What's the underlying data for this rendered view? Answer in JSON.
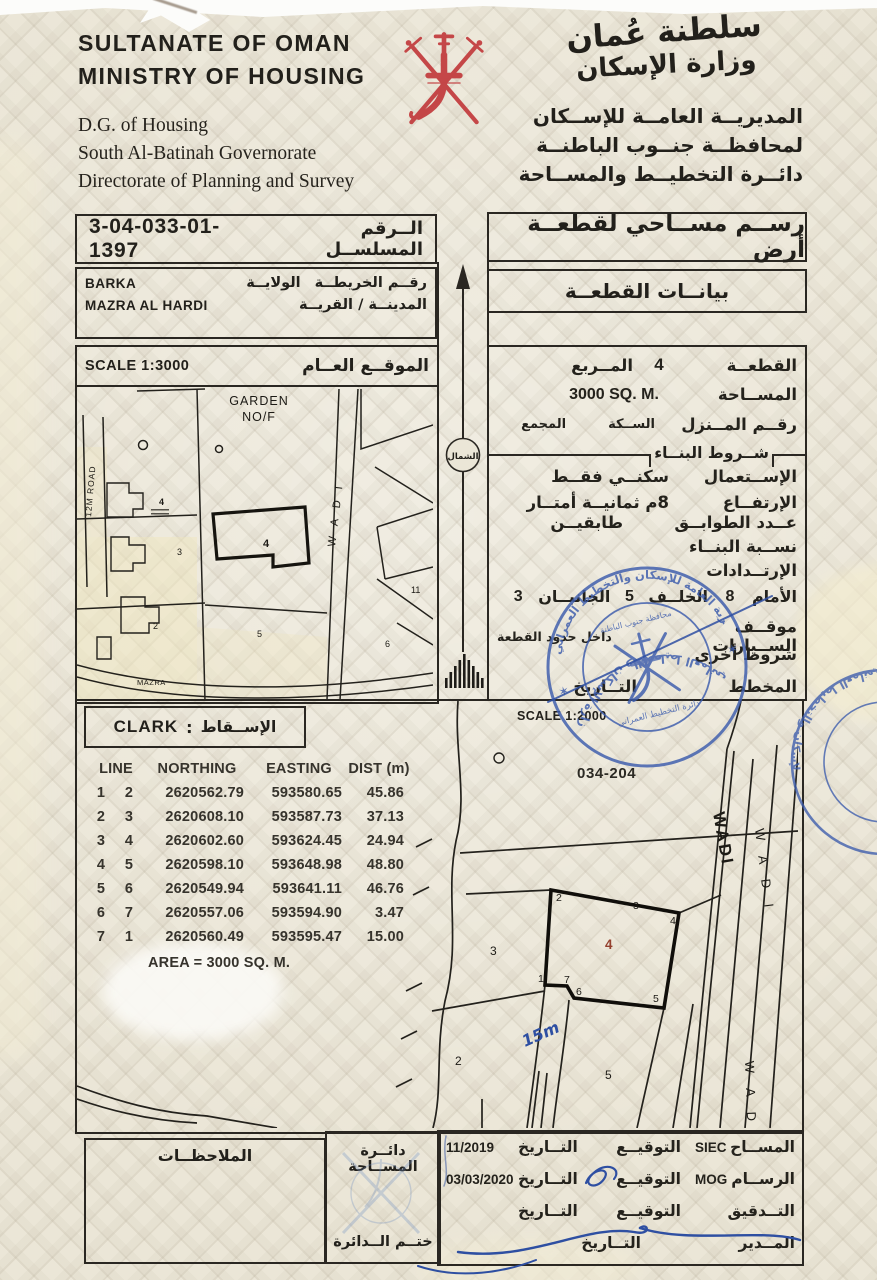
{
  "doc": {
    "en_title1": "SULTANATE OF OMAN",
    "en_title2": "MINISTRY OF HOUSING",
    "en_dept1": "D.G. of Housing",
    "en_dept2": "South Al-Batinah Governorate",
    "en_dept3": "Directorate of Planning and Survey",
    "ar_callig1": "سلطنة عُمان",
    "ar_callig2": "وزارة الإسكان",
    "ar_dept1": "المديريــة العامــة للإســكان",
    "ar_dept2": "لمحافظــة جنــوب الباطنــة",
    "ar_dept3": "دائــرة التخطيــط والمســاحة"
  },
  "serial": {
    "label": "الــرقم المسلســل",
    "value": "3-04-033-01-1397"
  },
  "title": {
    "text": "رســم مســاحي لقطعــة أرض",
    "plot_box": "بيانــات القطعــة"
  },
  "location": {
    "map_no_label": "رقــم الخريطــة",
    "wilaya_label": "الولايــة",
    "wilaya": "BARKA",
    "town_label": "المدينــة / القريــة",
    "town": "MAZRA AL HARDI"
  },
  "plot": {
    "plot_label": "القطعــة",
    "plot_no": "4",
    "square_label": "المــربع",
    "area_label": "المســاحة",
    "area_value": "3000 SQ. M.",
    "house_label": "رقــم المــنزل",
    "street_label": "الســكة",
    "complex_label": "المجمع",
    "cond_title": "شــروط البنــاء",
    "use_label": "الإســتعمال",
    "use_value": "سكنــي فقــط",
    "height_label": "الإرتفــاع",
    "height_value": "8م  ثمانيــة أمتــار",
    "floors_label": "عــدد الطوابــق",
    "floors_value": "طابقيــن",
    "ratio_label": "نســبة البنــاء",
    "setback_label": "الإرتــدادات",
    "front_label": "الأمام",
    "front": "8",
    "back_label": "الخلــف",
    "back": "5",
    "sides_label": "الجانبــان",
    "sides": "3",
    "parking_label": "موقــف الســيارات",
    "parking_value": "داخل حدود القطعة",
    "other_label": "شروط أخرى",
    "plan_label": "المخطط",
    "date_label": "التــاريخ"
  },
  "gmap": {
    "scale": "SCALE 1:3000",
    "title": "الموقــع العــام",
    "garden1": "GARDEN",
    "garden2": "NO/F",
    "wadi": "W A D I",
    "road": "12M ROAD",
    "mazra": "MAZRA",
    "p2": "2",
    "p3": "3",
    "p4": "4",
    "p5": "5",
    "p6": "6",
    "p11": "11",
    "north": "الشمال"
  },
  "proj": {
    "label": "الإســقاط",
    "value": "CLARK",
    "scale": "SCALE 1:2000",
    "sheet": "034-204"
  },
  "coords": {
    "h_line": "LINE",
    "h_n": "NORTHING",
    "h_e": "EASTING",
    "h_d": "DIST (m)",
    "rows": [
      [
        "1",
        "2",
        "2620562.79",
        "593580.65",
        "45.86"
      ],
      [
        "2",
        "3",
        "2620608.10",
        "593587.73",
        "37.13"
      ],
      [
        "3",
        "4",
        "2620602.60",
        "593624.45",
        "24.94"
      ],
      [
        "4",
        "5",
        "2620598.10",
        "593648.98",
        "48.80"
      ],
      [
        "5",
        "6",
        "2620549.94",
        "593641.11",
        "46.76"
      ],
      [
        "6",
        "7",
        "2620557.06",
        "593594.90",
        "3.47"
      ],
      [
        "7",
        "1",
        "2620560.49",
        "593595.47",
        "15.00"
      ]
    ],
    "area": "AREA = 3000 SQ. M."
  },
  "dmap": {
    "wadi_bold": "WADI",
    "wadi_sp": "W A D I",
    "wadi_v": "W A D I",
    "note15": "15m",
    "center_no": "4",
    "n2": "2",
    "n3": "3",
    "n5": "5",
    "v1": "1",
    "v2": "2",
    "v3": "3",
    "v4": "4",
    "v5": "5",
    "v6": "6",
    "v7": "7"
  },
  "footer": {
    "notes": "الملاحظــات",
    "office": "دائــرة المســاحة",
    "seal": "ختــم الــدائرة",
    "surveyor_label": "المســاح",
    "surveyor": "SIEC",
    "draftsman_label": "الرســام",
    "draftsman": "MOG",
    "audit_label": "التــدقيق",
    "director_label": "المــدير",
    "sign_label": "التوقيــع",
    "date_label": "التــاريخ",
    "date1": "11/2019",
    "date2": "03/03/2020"
  },
  "stamps": {
    "s1_top": "المديرية العامة للإسكان والتخطيط العمراني",
    "s1_bottom": "وزارة الإسكان والتخطيط العماني",
    "s1_in1": "محافظة جنوب الباطنة",
    "s1_in2": "دائرة التخطيط العمراني",
    "s2": "وزارة الإسكان والتخطيط العماني"
  }
}
